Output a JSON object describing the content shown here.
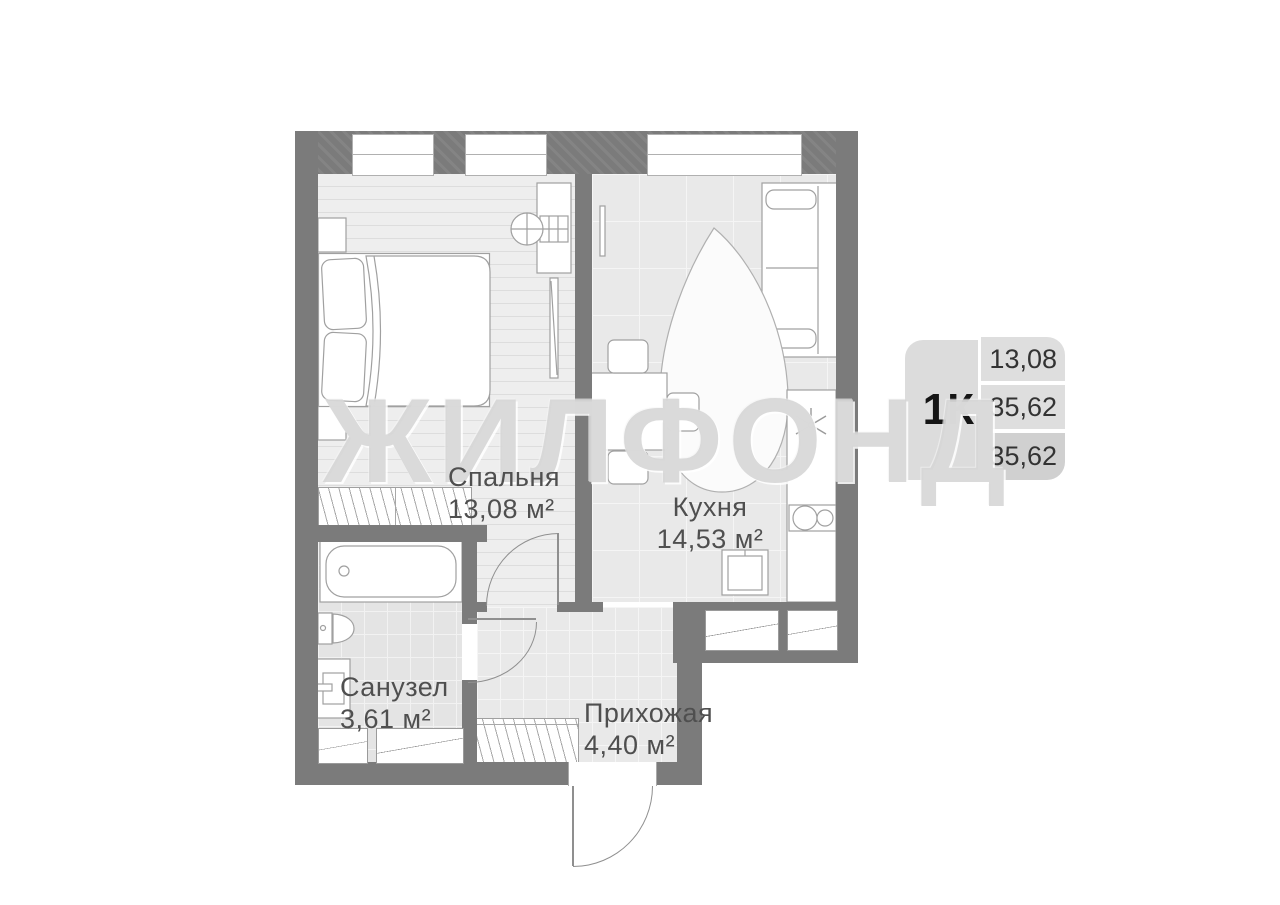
{
  "watermark": "ЖИЛФОНД",
  "rooms": {
    "bedroom": {
      "name": "Спальня",
      "area": "13,08 м²"
    },
    "kitchen": {
      "name": "Кухня",
      "area": "14,53 м²"
    },
    "bathroom": {
      "name": "Санузел",
      "area": "3,61 м²"
    },
    "hallway": {
      "name": "Прихожая",
      "area": "4,40 м²"
    }
  },
  "info_box": {
    "type_label": "1К",
    "values": [
      "13,08",
      "35,62",
      "35,62"
    ]
  },
  "colors": {
    "wall": "#7b7b7b",
    "floor": "#e9e9e9",
    "label_text": "#4f4f4f",
    "info_row": "#dedede",
    "info_row_dark": "#d0d0d0"
  }
}
